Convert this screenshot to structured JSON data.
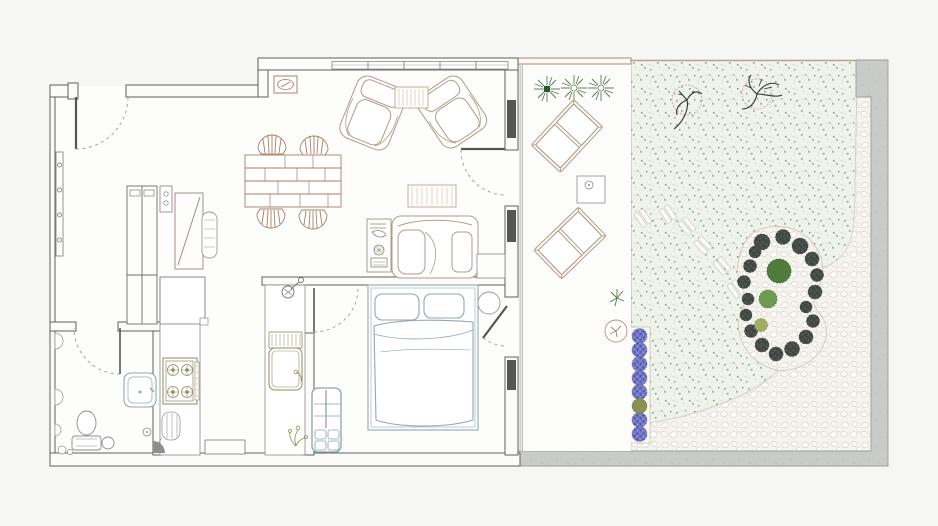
{
  "title": "Apartment floor plan with terrace and garden",
  "plan": {
    "rooms": [
      {
        "id": "entry-hall",
        "label": "Entry hall"
      },
      {
        "id": "living-dining",
        "label": "Living and dining room"
      },
      {
        "id": "kitchen",
        "label": "Kitchen"
      },
      {
        "id": "bathroom",
        "label": "Bathroom"
      },
      {
        "id": "bedroom",
        "label": "Bedroom"
      },
      {
        "id": "terrace",
        "label": "Terrace"
      },
      {
        "id": "garden",
        "label": "Garden"
      }
    ],
    "furniture": {
      "entry_hall": [
        "coat-hook-strip",
        "tall-closet",
        "wardrobe-with-mirror",
        "hanging-clothes-roll"
      ],
      "living_dining": [
        "dining-table-brick-top",
        "dining-chair x4",
        "armchair x2",
        "striped-rug x2",
        "sofa-with-chaise",
        "side-table-with-lamp",
        "wall-vent",
        "corner-cabinet"
      ],
      "kitchen": [
        "upper-cabinet",
        "counter-left",
        "gas-stove-4-burner",
        "radiator-basket",
        "counter-right",
        "drainboard",
        "kitchen-sink",
        "gas-valve",
        "flower-sprig",
        "floor-niche"
      ],
      "bathroom": [
        "wall-sconce x2",
        "washbasin",
        "toilet-with-cistern",
        "storage-jar",
        "floor-drain",
        "corner-shower-tray"
      ],
      "bedroom": [
        "double-bed",
        "pillow x2",
        "duvet",
        "bedside-stool",
        "dresser-with-drawers"
      ],
      "terrace": [
        "potted-plant x3",
        "lounge-chair x2",
        "side-table",
        "plant-sprig",
        "round-planter"
      ]
    },
    "garden": {
      "features": [
        "lawn",
        "bare-tree x2",
        "stepping-stone-path",
        "kidney-shrub-bed",
        "green-bush x3",
        "lavender-border",
        "pebble-path",
        "perimeter-concrete-wall"
      ],
      "counts": {
        "stepping_stone_groups": 6,
        "lavender_plants": 9,
        "dark_shrubs": 18,
        "green_bushes": 3,
        "terrace_potted_plants": 3,
        "trees": 2
      }
    }
  },
  "palette": {
    "background": "#f6f6f5",
    "floor": "#fdfdfc",
    "wall_stroke": "#5f5f5f",
    "wall_fill": "#fbfbfa",
    "window_glass": "#565656",
    "door_dash": "#9b9b9b",
    "brown": "#b59a85",
    "brown_deep": "#ab7f63",
    "vent_brown": "#a5765a",
    "olive": "#8f8a62",
    "plant_olive": "#8a9150",
    "bath_gray": "#8d8d8d",
    "teal_gray": "#92a9ad",
    "dresser_teal": "#8ba4a9",
    "grass_base": "#eff3ec",
    "grass_speckle": "#8fae85",
    "grass_speckle_dark": "#6f9665",
    "grass_swirl": "#dde8d8",
    "stone_bg": "#f5f3ee",
    "stone_stroke": "#d9d2c6",
    "concrete": "#c9cbc9",
    "concrete_stroke": "#9a9c9a",
    "shrub_dark": "#454b45",
    "bush_large": "#4f7c3b",
    "bush_mid": "#6f9a52",
    "bush_small": "#a3ad62",
    "lavender": "#7277c4",
    "lavender_dark": "#41489f",
    "tree_branch": "#33362f",
    "tree_canopy": "#cfa49a",
    "terrace_plant": "#5d7f54"
  }
}
